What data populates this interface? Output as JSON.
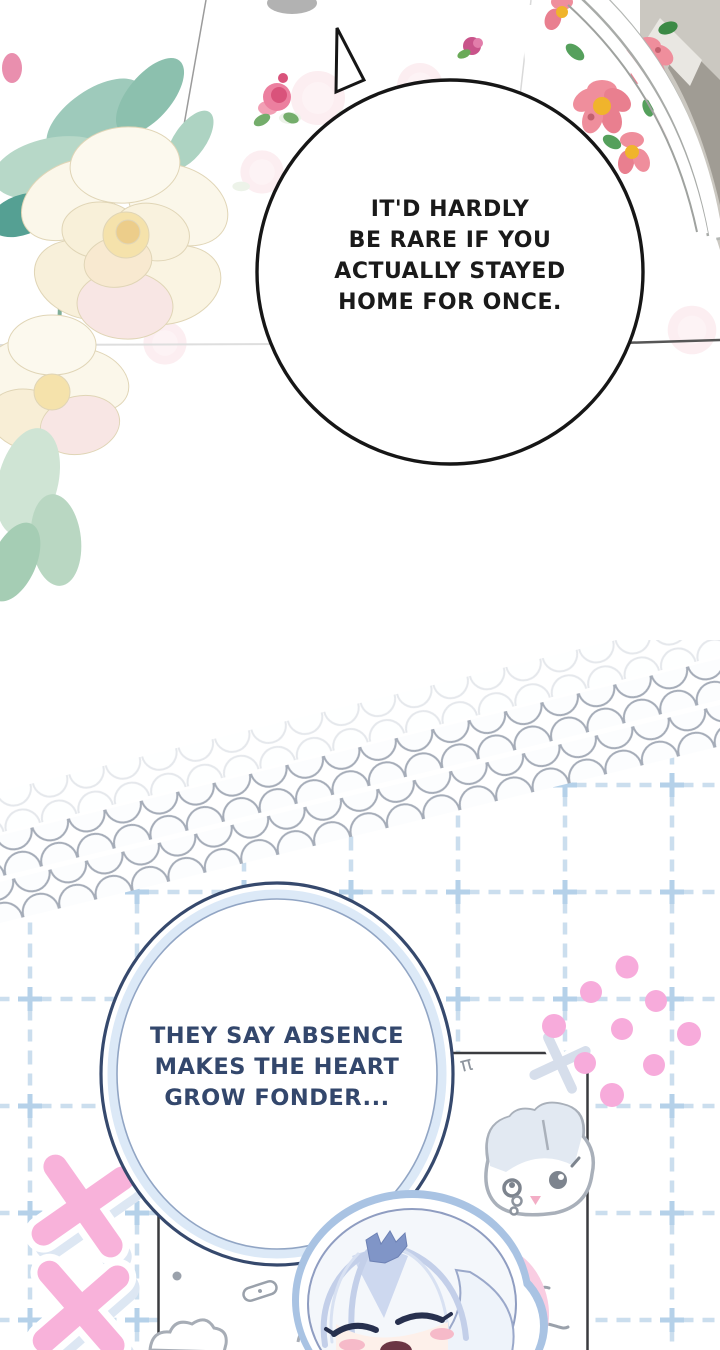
{
  "scene": {
    "kind": "webtoon comic panels",
    "background_color": "#ffffff"
  },
  "bubble1": {
    "lines": [
      "IT'D HARDLY",
      "BE RARE IF YOU",
      "ACTUALLY STAYED",
      "HOME FOR ONCE."
    ],
    "text_color": "#1a1a1a",
    "outline_color": "#161616"
  },
  "bubble2": {
    "lines": [
      "THEY SAY ABSENCE",
      "MAKES THE HEART",
      "GROW FONDER..."
    ],
    "text_color": "#33476c",
    "outline_color": "#36496d",
    "inner_band_color": "#dce9f7"
  },
  "decor": {
    "white_rose_bouquet": "cream roses with teal leaves, top left",
    "floral_plate": "pink flowers with yellow centers on white plate rim, top right",
    "pearl_strands": "three diagonal strands of pearls",
    "grid_line_color": "#cbdeee",
    "pearl_outline_color": "#a5acb8",
    "pink_dot_color": "#f7abdb",
    "pink_x_color": "#f8b2da",
    "pink_x_shadow_color": "#dde7f3",
    "x_sticker_color": "#d6deeb",
    "sketch_panel_border_color": "#3a3b3f",
    "doodle_gray_color": "#969ca6",
    "bunny_fill_color": "#e2e9f2",
    "bunny_nose_color": "#f3aec6",
    "hair_shade_color": "#c3cfe9",
    "hair_tuft_color": "#8095c7",
    "blush_color": "#f6bac9",
    "glow_pink_color": "#f9cde2"
  }
}
